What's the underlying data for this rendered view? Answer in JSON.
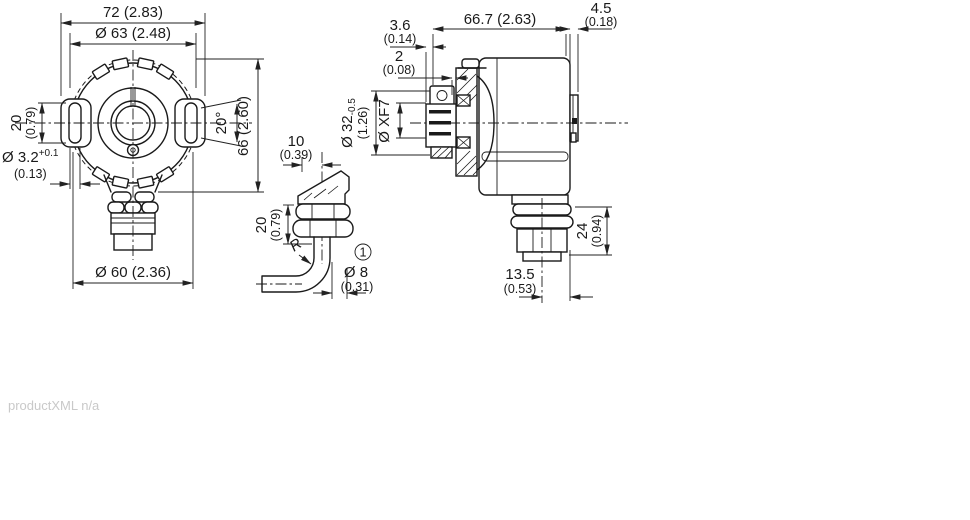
{
  "footer": {
    "note": "productXML n/a"
  },
  "front_view": {
    "overall_width": "72 (2.83)",
    "flange_circle_dia": "Ø 63 (2.48)",
    "slot_length_mm": "20",
    "slot_length_in": "(0.79)",
    "slot_width_mm": "Ø 3.2",
    "slot_width_tol": "+0.1",
    "slot_width_in": "(0.13)",
    "slot_angle": "20°",
    "overall_height": "66 (2.60)",
    "body_dia": "Ø 60 (2.36)"
  },
  "cable_detail": {
    "offset_mm": "10",
    "offset_in": "(0.39)",
    "gland_length_mm": "20",
    "gland_length_in": "(0.79)",
    "bend_radius": "R",
    "callout": "1",
    "cable_dia_mm": "Ø 8",
    "cable_dia_in": "(0.31)"
  },
  "side_view": {
    "clamp_offset_mm": "3.6",
    "clamp_offset_in": "(0.14)",
    "overall_depth": "66.7 (2.63)",
    "rear_depth_mm": "4.5",
    "rear_depth_in": "(0.18)",
    "gap_mm": "2",
    "gap_in": "(0.08)",
    "hub_dia_mm": "Ø 32",
    "hub_dia_tol": "-0.5",
    "hub_dia_in": "(1.26)",
    "bore_dia": "Ø XF7",
    "connector_height_mm": "24",
    "connector_height_in": "(0.94)",
    "connector_offset_mm": "13.5",
    "connector_offset_in": "(0.53)"
  }
}
